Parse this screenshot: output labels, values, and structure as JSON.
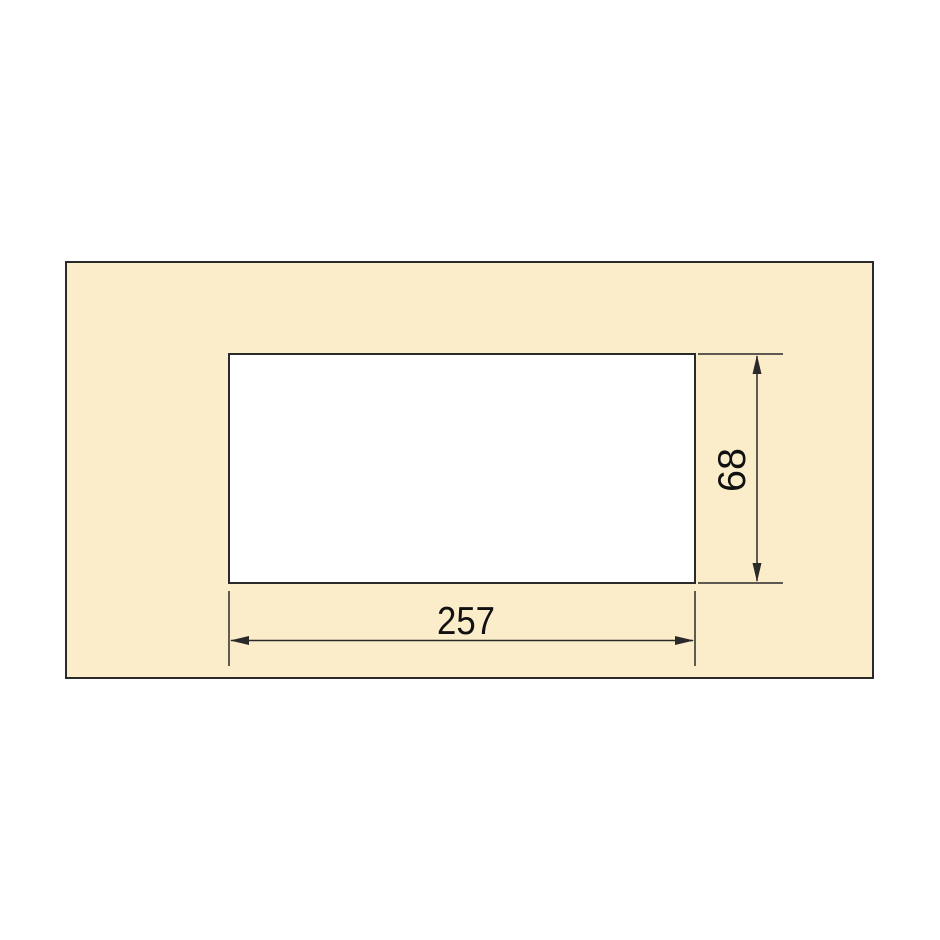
{
  "page": {
    "background": "#FFFFFF"
  },
  "drawing": {
    "kind": "technical-dimension-drawing",
    "panel": {
      "fill": "#FBEDCA",
      "outline": "#2A2A2A"
    },
    "cutout": {
      "fill": "#FFFFFF",
      "outline": "#2A2A2A"
    },
    "line_color": "#2A2A2A",
    "text_color": "#111111",
    "dimensions": {
      "width": {
        "label": "257"
      },
      "height": {
        "label": "68"
      }
    }
  }
}
